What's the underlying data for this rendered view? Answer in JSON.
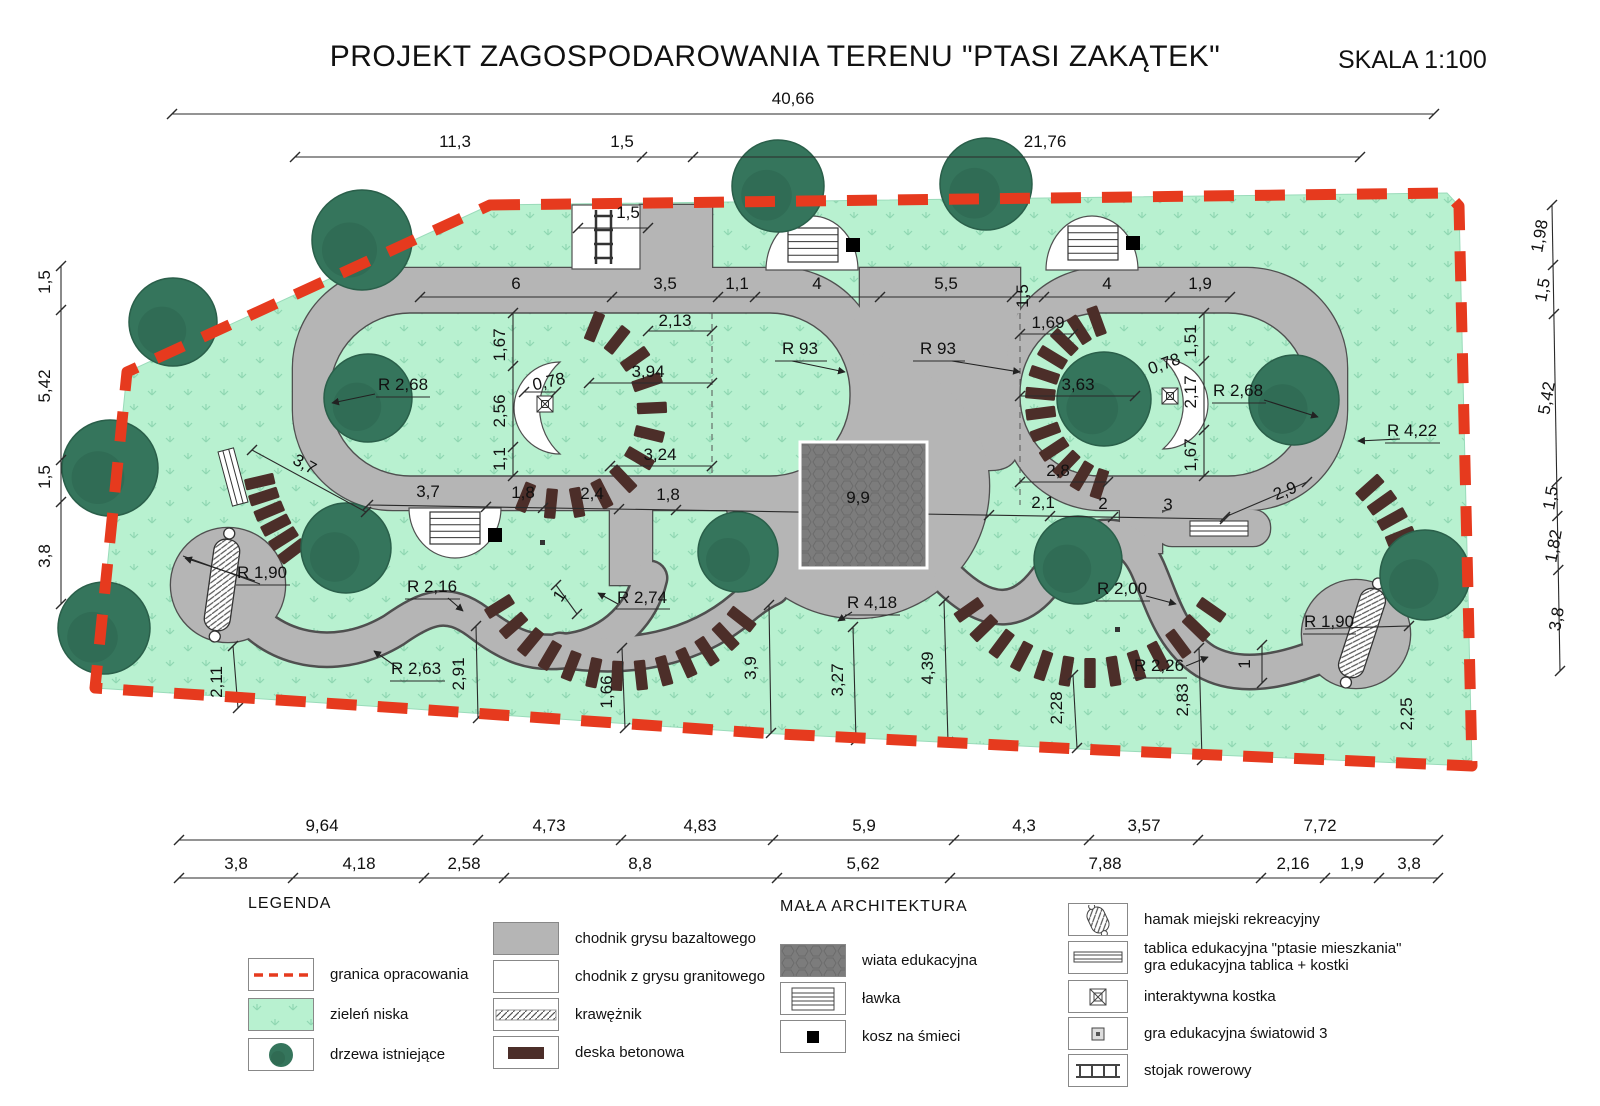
{
  "title": "PROJEKT ZAGOSPODAROWANIA TERENU \"PTASI ZAKĄTEK\"",
  "scale_label": "SKALA 1:100",
  "colors": {
    "boundary_red": "#e63a1e",
    "grass_green": "#b8f1d0",
    "tree_green": "#35755c",
    "path_gray": "#b5b5b5",
    "shelter_gray": "#7c7c7c",
    "plank_brown": "#4c2e29"
  },
  "plan": {
    "labels": [
      {
        "t": "40,66",
        "x": 793,
        "y": 104
      },
      {
        "t": "11,3",
        "x": 455,
        "y": 147
      },
      {
        "t": "1,5",
        "x": 622,
        "y": 147
      },
      {
        "t": "21,76",
        "x": 1045,
        "y": 147
      },
      {
        "t": "1,5",
        "x": 628,
        "y": 218
      },
      {
        "t": "6",
        "x": 516,
        "y": 289
      },
      {
        "t": "3,5",
        "x": 665,
        "y": 289
      },
      {
        "t": "1,1",
        "x": 737,
        "y": 289
      },
      {
        "t": "4",
        "x": 817,
        "y": 289
      },
      {
        "t": "5,5",
        "x": 946,
        "y": 289
      },
      {
        "t": "1,5",
        "x": 1028,
        "y": 296,
        "r": -90
      },
      {
        "t": "4",
        "x": 1107,
        "y": 289
      },
      {
        "t": "1,9",
        "x": 1200,
        "y": 289
      },
      {
        "t": "1,67",
        "x": 505,
        "y": 345,
        "r": -90
      },
      {
        "t": "2,56",
        "x": 505,
        "y": 411,
        "r": -90
      },
      {
        "t": "1,1",
        "x": 505,
        "y": 459,
        "r": -90
      },
      {
        "t": "2,13",
        "x": 675,
        "y": 326
      },
      {
        "t": "3,94",
        "x": 648,
        "y": 377
      },
      {
        "t": "3,24",
        "x": 660,
        "y": 460
      },
      {
        "t": "0,78",
        "x": 550,
        "y": 387,
        "r": -12
      },
      {
        "t": "R 2,68",
        "x": 403,
        "y": 390
      },
      {
        "t": "R 93",
        "x": 800,
        "y": 354
      },
      {
        "t": "R 93",
        "x": 938,
        "y": 354
      },
      {
        "t": "1,69",
        "x": 1048,
        "y": 328
      },
      {
        "t": "3,63",
        "x": 1078,
        "y": 390
      },
      {
        "t": "2,8",
        "x": 1058,
        "y": 476
      },
      {
        "t": "0,78",
        "x": 1166,
        "y": 369,
        "r": -20
      },
      {
        "t": "1,51",
        "x": 1196,
        "y": 341,
        "r": -90
      },
      {
        "t": "2,17",
        "x": 1196,
        "y": 392,
        "r": -90
      },
      {
        "t": "1,67",
        "x": 1196,
        "y": 455,
        "r": -90
      },
      {
        "t": "R 2,68",
        "x": 1238,
        "y": 396
      },
      {
        "t": "R 4,22",
        "x": 1412,
        "y": 436
      },
      {
        "t": "3,7",
        "x": 302,
        "y": 469,
        "r": 29
      },
      {
        "t": "3,7",
        "x": 428,
        "y": 497
      },
      {
        "t": "1,8",
        "x": 523,
        "y": 498
      },
      {
        "t": "2,4",
        "x": 592,
        "y": 499
      },
      {
        "t": "1,8",
        "x": 668,
        "y": 500
      },
      {
        "t": "9,9",
        "x": 858,
        "y": 503
      },
      {
        "t": "2,1",
        "x": 1043,
        "y": 508
      },
      {
        "t": "2",
        "x": 1103,
        "y": 509
      },
      {
        "t": "3",
        "x": 1168,
        "y": 510
      },
      {
        "t": "2,9",
        "x": 1287,
        "y": 496,
        "r": -22
      },
      {
        "t": "R 1,90",
        "x": 262,
        "y": 578
      },
      {
        "t": "R 2,16",
        "x": 432,
        "y": 592
      },
      {
        "t": "1",
        "x": 564,
        "y": 599,
        "r": -55
      },
      {
        "t": "R 2,74",
        "x": 642,
        "y": 603
      },
      {
        "t": "R 2,63",
        "x": 416,
        "y": 674
      },
      {
        "t": "R 4,18",
        "x": 872,
        "y": 608
      },
      {
        "t": "R 2,00",
        "x": 1122,
        "y": 594
      },
      {
        "t": "R 2,26",
        "x": 1159,
        "y": 671
      },
      {
        "t": "1",
        "x": 1250,
        "y": 664,
        "r": -90
      },
      {
        "t": "R 1,90",
        "x": 1329,
        "y": 627
      },
      {
        "t": "2,11",
        "x": 222,
        "y": 682,
        "r": -90
      },
      {
        "t": "2,91",
        "x": 464,
        "y": 674,
        "r": -90
      },
      {
        "t": "1,66",
        "x": 612,
        "y": 692,
        "r": -90
      },
      {
        "t": "3,9",
        "x": 756,
        "y": 668,
        "r": -90
      },
      {
        "t": "3,27",
        "x": 843,
        "y": 680,
        "r": -90
      },
      {
        "t": "4,39",
        "x": 933,
        "y": 668,
        "r": -90
      },
      {
        "t": "2,28",
        "x": 1062,
        "y": 708,
        "r": -90
      },
      {
        "t": "2,83",
        "x": 1188,
        "y": 700,
        "r": -90
      },
      {
        "t": "2,25",
        "x": 1412,
        "y": 714,
        "r": -90
      },
      {
        "t": "1,5",
        "x": 50,
        "y": 282,
        "r": -90
      },
      {
        "t": "5,42",
        "x": 50,
        "y": 386,
        "r": -90
      },
      {
        "t": "1,5",
        "x": 50,
        "y": 477,
        "r": -90
      },
      {
        "t": "3,8",
        "x": 50,
        "y": 556,
        "r": -90
      },
      {
        "t": "1,98",
        "x": 1545,
        "y": 237,
        "r": -80
      },
      {
        "t": "1,5",
        "x": 1548,
        "y": 291,
        "r": -80
      },
      {
        "t": "5,42",
        "x": 1552,
        "y": 399,
        "r": -80
      },
      {
        "t": "1,5",
        "x": 1556,
        "y": 499,
        "r": -80
      },
      {
        "t": "1,82",
        "x": 1559,
        "y": 547,
        "r": -80
      },
      {
        "t": "3,8",
        "x": 1562,
        "y": 620,
        "r": -80
      },
      {
        "t": "9,64",
        "x": 322,
        "y": 831
      },
      {
        "t": "4,73",
        "x": 549,
        "y": 831
      },
      {
        "t": "4,83",
        "x": 700,
        "y": 831
      },
      {
        "t": "5,9",
        "x": 864,
        "y": 831
      },
      {
        "t": "4,3",
        "x": 1024,
        "y": 831
      },
      {
        "t": "3,57",
        "x": 1144,
        "y": 831
      },
      {
        "t": "7,72",
        "x": 1320,
        "y": 831
      },
      {
        "t": "3,8",
        "x": 236,
        "y": 869
      },
      {
        "t": "4,18",
        "x": 359,
        "y": 869
      },
      {
        "t": "2,58",
        "x": 464,
        "y": 869
      },
      {
        "t": "8,8",
        "x": 640,
        "y": 869
      },
      {
        "t": "5,62",
        "x": 863,
        "y": 869
      },
      {
        "t": "7,88",
        "x": 1105,
        "y": 869
      },
      {
        "t": "2,16",
        "x": 1293,
        "y": 869
      },
      {
        "t": "1,9",
        "x": 1352,
        "y": 869
      },
      {
        "t": "3,8",
        "x": 1409,
        "y": 869
      }
    ]
  },
  "legend": {
    "title": "LEGENDA",
    "col1": [
      {
        "label": "granica opracowania",
        "icon": "boundary"
      },
      {
        "label": "zieleń niska",
        "icon": "lowgreen"
      },
      {
        "label": "drzewa istniejące",
        "icon": "tree"
      }
    ],
    "col2": [
      {
        "label": "chodnik grysu bazaltowego",
        "icon": "basalt"
      },
      {
        "label": "chodnik z grysu granitowego",
        "icon": "granite"
      },
      {
        "label": "krawężnik",
        "icon": "curb"
      },
      {
        "label": "deska betonowa",
        "icon": "plank"
      }
    ],
    "col3_title": "MAŁA  ARCHITEKTURA",
    "col3": [
      {
        "label": "wiata edukacyjna",
        "icon": "shelter"
      },
      {
        "label": "ławka",
        "icon": "bench"
      },
      {
        "label": "kosz na śmieci",
        "icon": "bin"
      }
    ],
    "col4": [
      {
        "label": "hamak miejski rekreacyjny",
        "icon": "hammock"
      },
      {
        "label": "tablica edukacyjna \"ptasie mieszkania\"\ngra edukacyjna tablica + kostki",
        "icon": "board"
      },
      {
        "label": "interaktywna kostka",
        "icon": "cube"
      },
      {
        "label": "gra edukacyjna światowid 3",
        "icon": "cube-small"
      },
      {
        "label": "stojak rowerowy",
        "icon": "bikerack"
      }
    ]
  }
}
